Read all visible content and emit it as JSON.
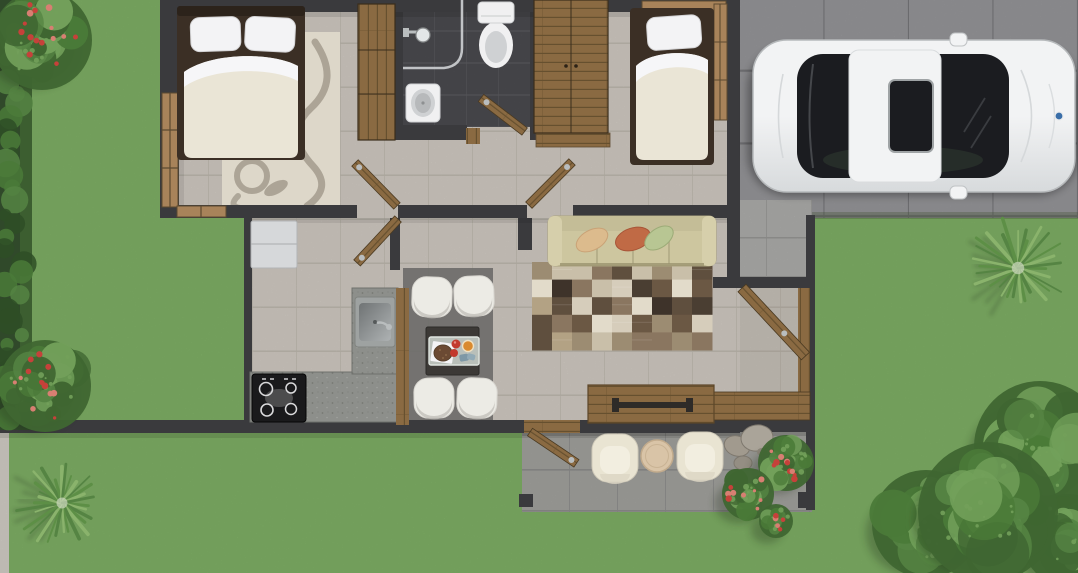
{
  "scene": {
    "kind": "3d-rendered-floor-plan-top-view",
    "rooms": [
      "bedroom-1",
      "bathroom",
      "bedroom-2",
      "hallway",
      "kitchen",
      "dining-area",
      "living-room",
      "patio",
      "porch",
      "driveway",
      "garden"
    ],
    "objects": [
      "double-bed",
      "single-bed",
      "wardrobe",
      "toilet",
      "shower",
      "bathroom-sink",
      "refrigerator",
      "kitchen-sink",
      "cooktop",
      "dining-table",
      "dining-chairs",
      "breakfast-tray",
      "sofa",
      "throw-cushions",
      "patchwork-rug",
      "sideboard",
      "patio-armchairs",
      "patio-side-table",
      "car",
      "rocks",
      "flower-bushes",
      "yucca-plants",
      "trees",
      "hedge"
    ]
  },
  "palette": {
    "grass": "#83b569",
    "grass_shade": "#6fa158",
    "hedge_dark": "#2e4d26",
    "hedge_leaf": "#4a7a38",
    "tree_dark": "#3f6631",
    "tree_mid": "#558443",
    "tree_light": "#72a05a",
    "yucca": "#5d8f46",
    "yucca_light": "#8ab36c",
    "flower_red": "#c6413a",
    "flower_pink": "#d87f72",
    "driveway": "#97979a",
    "driveway_line": "#7b7b7e",
    "pad": "#b3b3b1",
    "pad_line": "#9c9c9a",
    "patio": "#a7a7a3",
    "patio_line": "#929290",
    "walkway": "#d8d4cc",
    "wall": "#3a3a3d",
    "floor": "#d7d1c9",
    "floor_line": "#c3bdb3",
    "bath_tile": "#4d4d52",
    "bath_line": "#5e5e63",
    "wood": "#8a6a42",
    "wood_dark": "#66502f",
    "wood_light": "#a8835a",
    "bed_frame": "#3b2f25",
    "duvet": "#eae5d6",
    "sheet": "#f6f6f8",
    "pillow": "#f3f3f5",
    "rug_cream": "#ddd7c9",
    "rug_swirl": "#a39b8d",
    "sofa": "#cdc69f",
    "sofa_dark": "#b9b28c",
    "sofa_arm": "#d6cfab",
    "cushion_tan": "#dcbb8d",
    "cushion_orange": "#c06a45",
    "cushion_green": "#b8c693",
    "rug_patch": [
      "#3e332a",
      "#5f4f3e",
      "#8a7660",
      "#b3a284",
      "#d6cdbb",
      "#c9bfa9",
      "#6b5844",
      "#e2dbca",
      "#4a3e32",
      "#9c8c72"
    ],
    "dining_rug": "#6e6c6a",
    "chair_white": "#ecebe5",
    "chair_shade": "#bdbbb5",
    "table_dark": "#3c3936",
    "tray": "#b9bfb9",
    "napkin": "#f4f4f6",
    "bread": "#6b4a33",
    "tomato": "#c23a2e",
    "juice": "#d98a2e",
    "cup_blue": "#7e98a6",
    "counter": "#8d8f8b",
    "counter_speck": "#767872",
    "steel": "#b9bdbe",
    "steel_dark": "#86898a",
    "stove": "#1a1a1c",
    "burner": "#d9d9db",
    "fridge": "#d6d8da",
    "porcelain": "#f0f0f1",
    "porcelain_shade": "#cfd1d3",
    "glass_line": "#cfd2d4",
    "car_body": "#f2f3f4",
    "car_shade": "#d7dadc",
    "car_glass": "#1b1c20",
    "car_trim": "#9fa3a5",
    "badge_blue": "#3a6ea8",
    "rock": "#a19a8e",
    "rock_mid": "#aaa499",
    "rock_dark": "#7e786e",
    "armchair": "#e9e4d2",
    "side_table": "#d9c4a7"
  }
}
